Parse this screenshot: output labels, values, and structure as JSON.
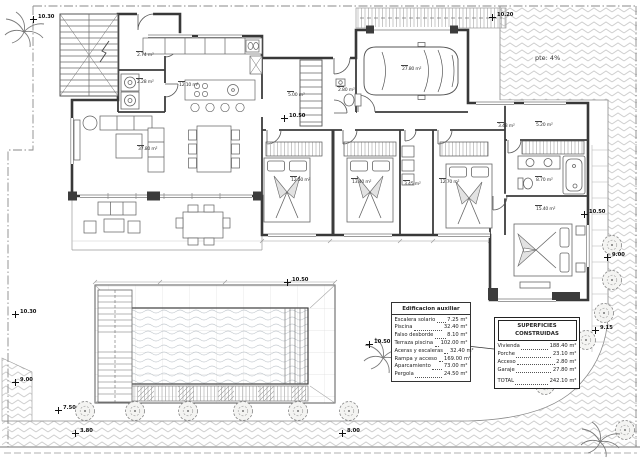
{
  "drawing": {
    "slope_label": "pte: 4%",
    "markers": [
      {
        "value": "10.30"
      },
      {
        "value": "10.20"
      },
      {
        "value": "10.50"
      },
      {
        "value": "10.50"
      },
      {
        "value": "10.50"
      },
      {
        "value": "9.00"
      },
      {
        "value": "10.30"
      },
      {
        "value": "9.00"
      },
      {
        "value": "7.50"
      },
      {
        "value": "3.80"
      },
      {
        "value": "8.00"
      },
      {
        "value": "10.50"
      },
      {
        "value": "8.15"
      },
      {
        "value": "9.15"
      }
    ],
    "room_areas": [
      {
        "area": "2.74 m²"
      },
      {
        "area": "2.28 m²"
      },
      {
        "area": "12.10 m²"
      },
      {
        "area": "37.80 m²"
      },
      {
        "area": "5.00 m²"
      },
      {
        "area": "2.80 m²"
      },
      {
        "area": "27.80 m²"
      },
      {
        "area": "12.50 m²"
      },
      {
        "area": "13.40 m²"
      },
      {
        "area": "3.45 m²"
      },
      {
        "area": "12.70 m²"
      },
      {
        "area": "3.48 m²"
      },
      {
        "area": "5.20 m²"
      },
      {
        "area": "8.70 m²"
      },
      {
        "area": "15.40 m²"
      }
    ]
  },
  "tables": {
    "aux": {
      "title": "Edificacion auxiliar",
      "rows": [
        {
          "label": "Escalera solario",
          "value": "7.25 m²"
        },
        {
          "label": "Piscina",
          "value": "32.40 m²"
        },
        {
          "label": "Falso desborde",
          "value": "8.10 m²"
        },
        {
          "label": "Terraza piscina",
          "value": "102.00 m²"
        },
        {
          "label": "Aceras y escaleras",
          "value": "32.40 m²"
        },
        {
          "label": "Rampa y acceso",
          "value": "169.00 m²"
        },
        {
          "label": "Aparcamiento",
          "value": "73.00 m²"
        },
        {
          "label": "Pergola",
          "value": "24.50 m²"
        }
      ]
    },
    "sup": {
      "title": "SUPERFICIES CONSTRUIDAS",
      "rows": [
        {
          "label": "Vivienda",
          "value": "188.40 m²"
        },
        {
          "label": "Porche",
          "value": "23.10 m²"
        },
        {
          "label": "Acceso",
          "value": "2.80 m²"
        },
        {
          "label": "Garaje",
          "value": "27.80 m²"
        }
      ],
      "total": {
        "label": "TOTAL",
        "value": "242.10 m²"
      }
    }
  }
}
